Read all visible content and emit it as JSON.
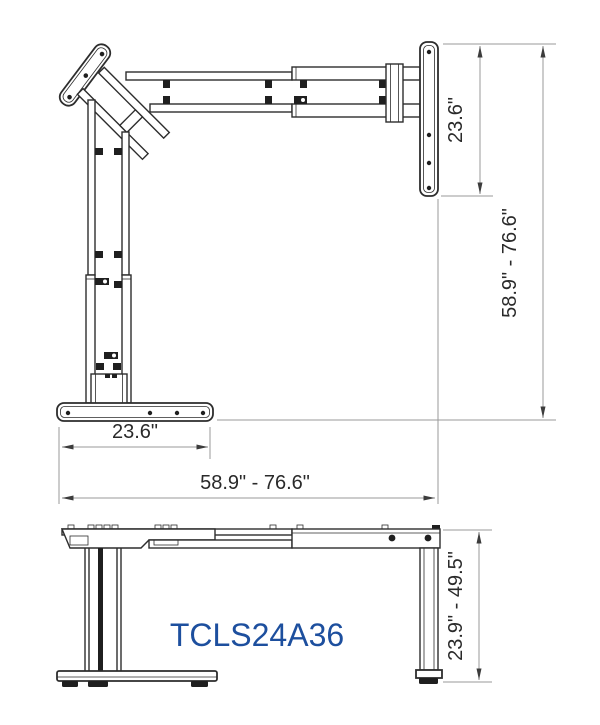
{
  "drawing": {
    "type": "technical-dimension-drawing",
    "model_label": "TCLS24A36",
    "views": {
      "top_view": {
        "name": "L-shaped desk frame - top view",
        "return_depth": "23.6\"",
        "overall_depth": "58.9\" - 76.6\"",
        "return_width": "23.6\"",
        "overall_width": "58.9\" - 76.6\""
      },
      "front_view": {
        "name": "desk frame - front view",
        "height_range": "23.9\" - 49.5\""
      }
    },
    "colors": {
      "line": "#2d2d2d",
      "dimension_line": "#9a9a9a",
      "dimension_text": "#2a2a2a",
      "model_text": "#1d4f9e",
      "background": "#ffffff"
    }
  }
}
